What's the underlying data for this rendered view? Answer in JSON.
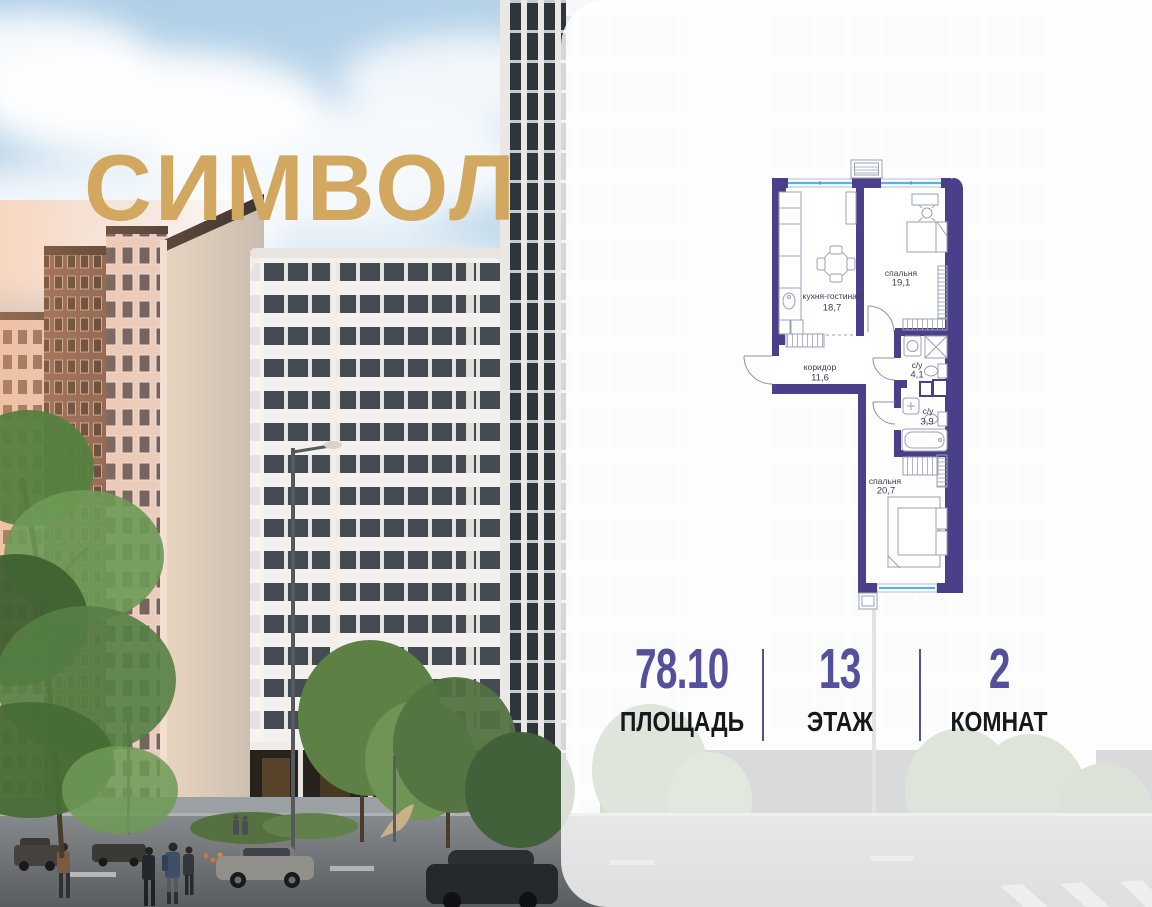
{
  "brand": {
    "logo_text": "СИМВОЛ",
    "logo_color": "#d2a75f"
  },
  "floorplan": {
    "wall_color": "#494089",
    "window_color": "#4db4e4",
    "rooms": [
      {
        "name": "кухня-гостиная",
        "area": "18,7"
      },
      {
        "name": "спальня",
        "area": "19,1"
      },
      {
        "name": "коридор",
        "area": "11,6"
      },
      {
        "name": "с/у",
        "area": "4,1"
      },
      {
        "name": "с/у",
        "area": "3,9"
      },
      {
        "name": "спальня",
        "area": "20,7"
      }
    ]
  },
  "stats": {
    "accent_color": "#54509b",
    "items": [
      {
        "value": "78.10",
        "label": "ПЛОЩАДЬ"
      },
      {
        "value": "13",
        "label": "ЭТАЖ"
      },
      {
        "value": "2",
        "label": "КОМНАТ"
      }
    ]
  }
}
